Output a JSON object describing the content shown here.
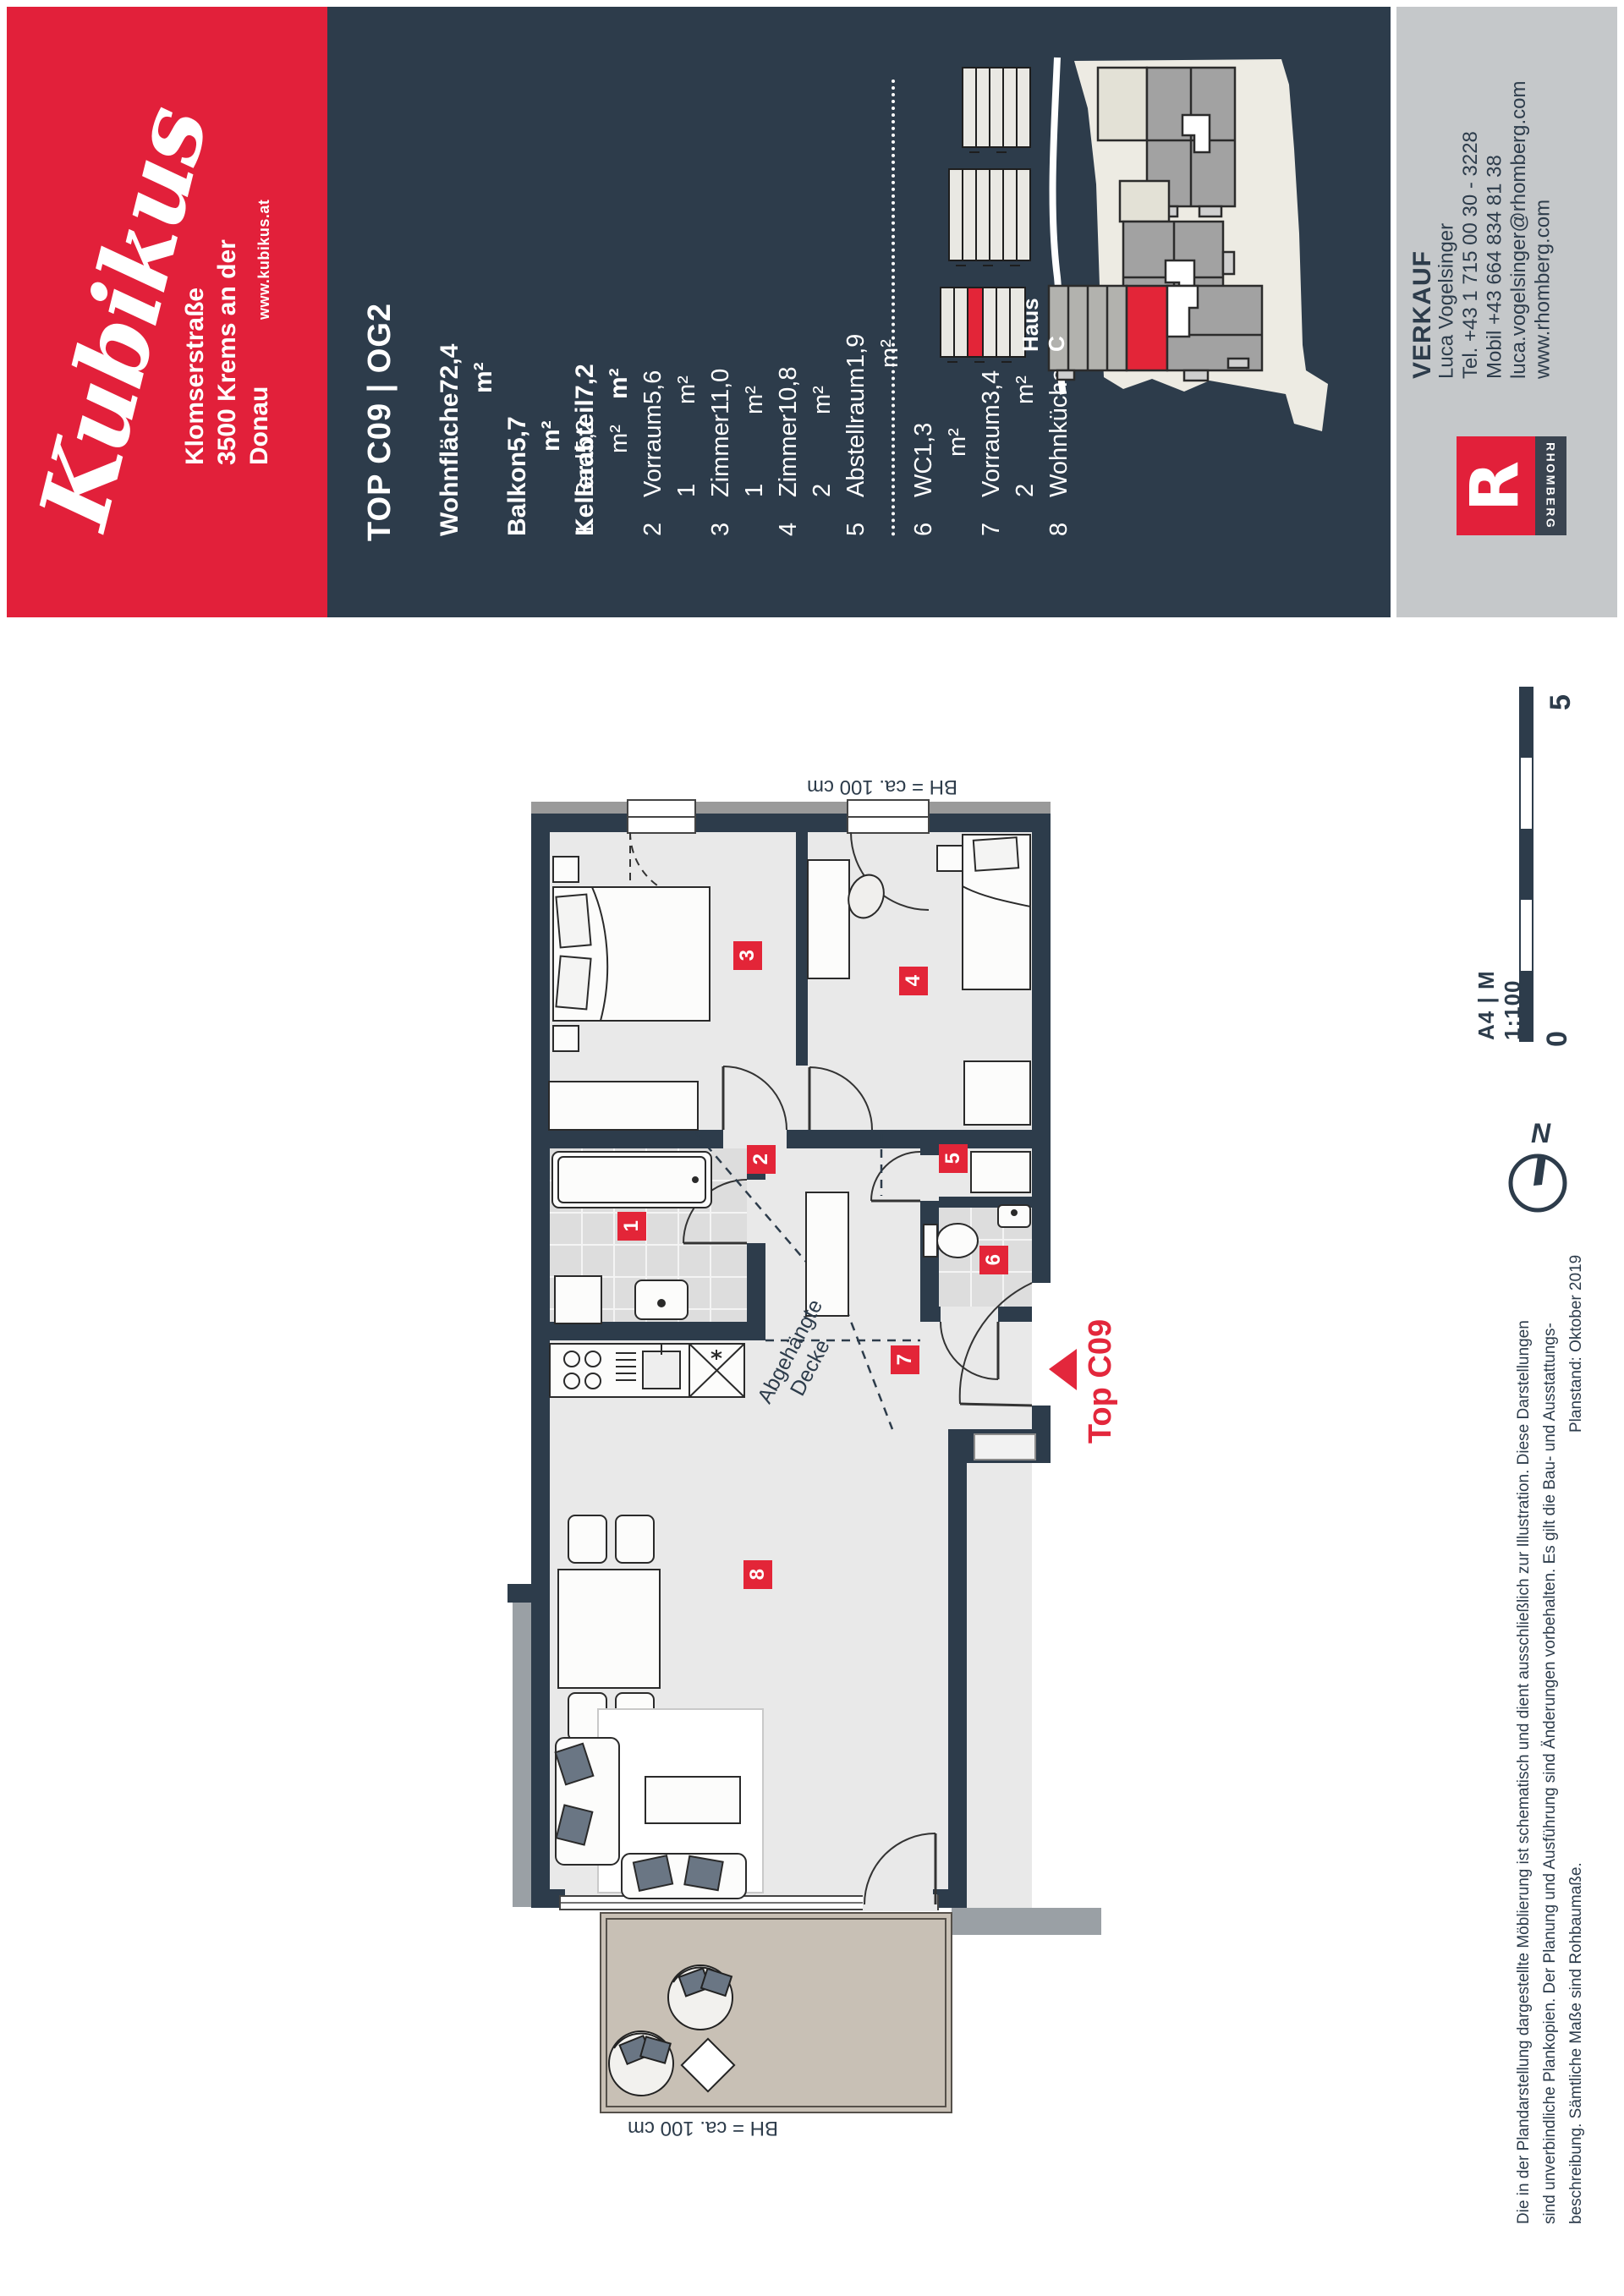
{
  "brand": {
    "logo_text": "Kubikus",
    "street": "Klomserstraße",
    "city": "3500 Krems an der Donau",
    "website": "www.kubikus.at"
  },
  "unit": {
    "title": "TOP C09 | OG2",
    "stats": [
      {
        "label": "Wohnfläche",
        "value": "72,4 m²"
      },
      {
        "label": "Balkon",
        "value": "5,7 m²"
      },
      {
        "label": "Kellerabteil",
        "value": "7,2 m²"
      }
    ],
    "rooms": [
      {
        "number": "1",
        "name": "Bad",
        "area": "5,2 m²"
      },
      {
        "number": "2",
        "name": "Vorraum 1",
        "area": "5,6 m²"
      },
      {
        "number": "3",
        "name": "Zimmer 1",
        "area": "11,0 m²"
      },
      {
        "number": "4",
        "name": "Zimmer 2",
        "area": "10,8 m²"
      },
      {
        "number": "5",
        "name": "Abstellraum",
        "area": "1,9 m²"
      },
      {
        "number": "6",
        "name": "WC",
        "area": "1,3 m²"
      },
      {
        "number": "7",
        "name": "Vorraum 2",
        "area": "3,4 m²"
      },
      {
        "number": "8",
        "name": "Wohnküche",
        "area": "32,8 m²"
      }
    ]
  },
  "site": {
    "building_label": "Haus C"
  },
  "contact": {
    "heading": "VERKAUF",
    "name": "Luca Vogelsinger",
    "tel": "Tel. +43 1 715 00 30 - 3228",
    "mobile": "Mobil +43 664 834 81 38",
    "email": "luca.vogelsinger@rhomberg.com",
    "web": "www.rhomberg.com",
    "logo_letter": "R",
    "logo_text": "RHOMBERG"
  },
  "plan": {
    "unit_label": "Top C09",
    "parapet_note_top": "BH = ca. 100 cm",
    "parapet_note_bottom": "BH = ca. 100 cm",
    "ceiling_note_line1": "Abgehängte",
    "ceiling_note_line2": "Decke",
    "scale_text": "A4 | M 1:100",
    "scale_start": "0",
    "scale_end": "5",
    "north_label": "N"
  },
  "footer": {
    "line1": "Die in der Plandarstellung dargestellte Möblierung ist schematisch und dient ausschließlich zur Illustration. Diese Darstellungen",
    "line2": "sind unverbindliche Plankopien. Der Planung und Ausführung sind Änderungen vorbehalten. Es gilt die Bau- und Ausstattungs-",
    "line3": "beschreibung. Sämtliche Maße sind Rohbaumaße.",
    "line3_right": "Planstand: Oktober 2019"
  },
  "colors": {
    "brand_red": "#e2203a",
    "navy": "#2d3c4b",
    "band_gray": "#c5c8ca",
    "highlight_red": "#e32538",
    "floor": "#e9e9e9",
    "balcony_floor": "#c8c0b5"
  }
}
